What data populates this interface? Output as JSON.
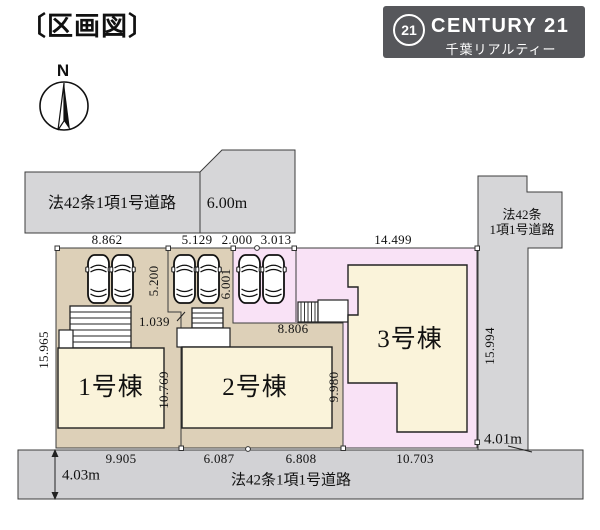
{
  "header": {
    "title": "〔区画図〕"
  },
  "logo": {
    "mark": "21",
    "brand": "CENTURY 21",
    "subtitle": "千葉リアルティー"
  },
  "compass": {
    "north": "N"
  },
  "roads": {
    "top": {
      "name": "法42条1項1号道路",
      "width": "6.00m"
    },
    "right": {
      "name_line1": "法42条",
      "name_line2": "1項1号道路",
      "width": "4.01m"
    },
    "bottom": {
      "name": "法42条1項1号道路",
      "width": "4.03m"
    }
  },
  "buildings": [
    {
      "label": "1号棟"
    },
    {
      "label": "2号棟"
    },
    {
      "label": "3号棟"
    }
  ],
  "dims": {
    "top": [
      "8.862",
      "5.129",
      "2.000",
      "3.013",
      "14.499"
    ],
    "bottom": [
      "9.905",
      "6.087",
      "6.808",
      "10.703"
    ],
    "left": "15.965",
    "right": "15.994",
    "lot1_parking_depth": "5.200",
    "lot2_parking_depth": "6.001",
    "lot1_boundary_lower": "10.769",
    "lot3_boundary_lower": "9.980",
    "lot1_offset": "1.039",
    "lot23_boundary": "8.806"
  },
  "colors": {
    "road_gray": "#d6d6d8",
    "lot_tan": "#ddd0b8",
    "lot_pink": "#f9e2f6",
    "building_cream": "#faf3da",
    "logo_bg": "#56575b"
  }
}
